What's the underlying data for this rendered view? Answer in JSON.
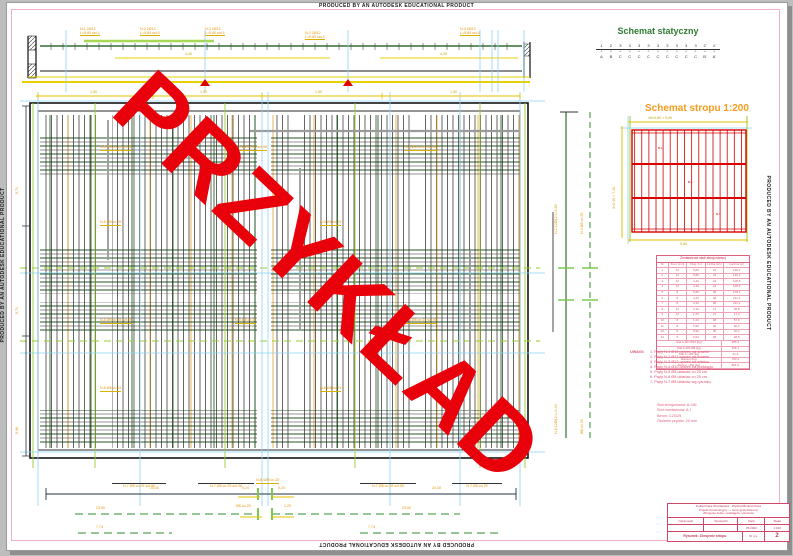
{
  "banner": {
    "text": "PRODUCED BY AN AUTODESK EDUCATIONAL PRODUCT"
  },
  "watermark": {
    "text": "PRZYKŁAD"
  },
  "static_scheme": {
    "title": "Schemat statyczny",
    "numbers": [
      "1",
      "2",
      "3",
      "3",
      "3",
      "3",
      "3",
      "3",
      "3",
      "3",
      "3",
      "2'",
      "1'"
    ],
    "supports": [
      "▵",
      "▵",
      "▵",
      "▵",
      "▵",
      "▵",
      "▵",
      "▵",
      "▵",
      "▵",
      "▵",
      "▵",
      "▵"
    ],
    "letters": [
      "A",
      "B",
      "C",
      "C",
      "C",
      "C",
      "C",
      "C",
      "C",
      "C",
      "C",
      "B'",
      "A'"
    ]
  },
  "slab_scheme": {
    "title": "Schemat stropu 1:200",
    "dim_top": "16×0,60 = 9,60",
    "dim_bottom": "9,84",
    "dim_left": "3×2,40 = 7,20",
    "cell_labels": [
      "B-1",
      "B-1",
      "B-1"
    ]
  },
  "steel_table": {
    "title": "Zestawienie stali zbrojeniowej",
    "headers": [
      "Nr",
      "Śred. [mm]",
      "Dług. [m]",
      "Liczba [szt.]",
      "Łącznie [m]"
    ],
    "rows": [
      [
        "1",
        "12",
        "5,80",
        "24",
        "139,2"
      ],
      [
        "2",
        "12",
        "5,80",
        "24",
        "139,2"
      ],
      [
        "3",
        "12",
        "4,40",
        "24",
        "105,6"
      ],
      [
        "4",
        "12",
        "4,40",
        "24",
        "105,6"
      ],
      [
        "5",
        "8",
        "5,80",
        "48",
        "278,4"
      ],
      [
        "6",
        "8",
        "4,40",
        "48",
        "211,2"
      ],
      [
        "7",
        "8",
        "2,20",
        "96",
        "211,2"
      ],
      [
        "8",
        "12",
        "2,40",
        "12",
        "28,8"
      ],
      [
        "9",
        "12",
        "1,20",
        "12",
        "14,4"
      ],
      [
        "10",
        "8",
        "1,20",
        "48",
        "57,6"
      ],
      [
        "11",
        "8",
        "0,96",
        "96",
        "92,2"
      ],
      [
        "12",
        "6",
        "0,96",
        "96",
        "92,2"
      ],
      [
        "13",
        "6",
        "0,60",
        "48",
        "28,8"
      ]
    ],
    "summary": [
      [
        "Stal A-IIIN Ø12 [kg]",
        "385,4"
      ],
      [
        "Stal A-IIIN Ø8 [kg]",
        "336,1"
      ],
      [
        "Stal A-I Ø6 [kg]",
        "41,9"
      ],
      [
        "Razem [kg]",
        "763,4"
      ],
      [
        "Razem +5% [kg]",
        "801,6"
      ]
    ]
  },
  "uwagi": {
    "label": "UWAGI:",
    "items": [
      "1. Pręty N-1 Ø12 oprzeć na ścianie",
      "2. Pręty N-2 Ø12 oprzeć na ścianie",
      "3. Pręty N-3 Ø12 oprzeć na wieńcu",
      "4. Pręty N-4 Ø10 oprzeć na podciągu",
      "5. Pręty N-5 Ø8 układać co 25 cm",
      "6. Pręty N-6 Ø8 układać co 25 cm",
      "7. Pręty N-7 Ø8 układać wg rysunku"
    ]
  },
  "materials": {
    "lines": [
      "Stal zbrojeniowa: A-IIIN",
      "Stal montażowa: A-I",
      "Beton: C20/25",
      "Otulenie prętów: 20 mm"
    ]
  },
  "title_block": {
    "head": [
      "Politechnika Wrocławska · Wydział Budownictwa",
      "Projekt konstrukcyjny — strop gęstożebrowy",
      "Zbrojenie żeber, podciągów i wieńców"
    ],
    "labels": [
      "Opracował",
      "Sprawdził",
      "Data",
      "Skala"
    ],
    "values": [
      "",
      "",
      "05.2023",
      "1:100"
    ],
    "drawing_label": "Rysunek: Zbrojenie stropu",
    "no_label": "Nr rys.",
    "no_value": "2"
  },
  "beam_labels": [
    [
      "N-1 2Ø12",
      "L=5,80 szt.4"
    ],
    [
      "N-2 2Ø12",
      "L=5,80 szt.4"
    ],
    [
      "N-3 2Ø12",
      "L=5,80 szt.4"
    ],
    [
      "N-2 2Ø12",
      "L=5,80 szt.4"
    ],
    [
      "N-4 2Ø12",
      "L=5,80 szt.4"
    ]
  ],
  "beam_dims": {
    "mid_left": "4,40",
    "mid_right": "4,40"
  },
  "top_dim_labels": [
    "1,50",
    "1,50",
    "1,50",
    "1,50"
  ],
  "plan_labels": [
    "N-5 Ø8 co 25 szt.96",
    "N-5 Ø8 co 25 szt.96",
    "N-5 Ø8 co 25 szt.96",
    "N-6 Ø8 co 25",
    "N-6 Ø8 co 25",
    "N-5 Ø8 co 25 szt.96",
    "N-5 Ø8 co 25",
    "N-5 Ø8 co 25 szt.96",
    "N-6 Ø8 co 25",
    "N-6 Ø8 co 25"
  ],
  "right_labels": [
    "N-2 12Ø12 L=5,80",
    "N-4 Ø8 co 25",
    "N-6 12Ø12 L=4,40",
    "Ø8 co 25"
  ],
  "left_dims": [
    "5,74",
    "5,74",
    "5,96"
  ],
  "bottom_dims": {
    "overbar": [
      "N-7 Ø8 co 25 szt.96",
      "N-7 Ø8 co 25 szt.96",
      "N-7 Ø8 co 25 szt.96",
      "N-7 Ø8 co 25"
    ],
    "center_label": "N-8 4Ø8 co 25",
    "main_left": "24,40",
    "main_right": "24,40",
    "center_small_l": "0,24",
    "center_small_r": "0,24",
    "row2_left": "23,90",
    "row2_right": "23,90",
    "row2_mid_l": "Ø8 co 25",
    "row2_mid_r": "1,20",
    "row3_left": "7,74",
    "row3_right": "7,74"
  }
}
